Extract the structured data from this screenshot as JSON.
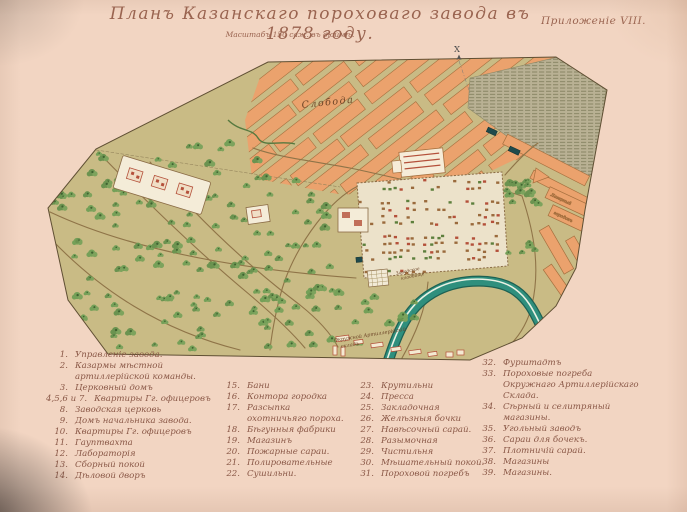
{
  "page": {
    "title": "Планъ Казанскаго пороховаго завода въ 1878 году.",
    "annex": "Приложеніе VIII.",
    "scale_note": "Масштабъ 150 саж. въ дюймѣ."
  },
  "map": {
    "labels": {
      "sloboda": "Слобода",
      "cemetery1": "Заводское",
      "cemetery2": "кладбище",
      "depot1": "Окружной Артиллерійскій",
      "depot2": "складъ",
      "camp1": "Лагерный",
      "camp2": "городокъ",
      "north_mark": "X"
    }
  },
  "legend": {
    "columns": [
      {
        "items": [
          {
            "n": "1.",
            "label": "Управленіе завода."
          },
          {
            "n": "2.",
            "label": "Казармы мѣстной артиллерійской команды."
          },
          {
            "n": "3.",
            "label": "Церковный домъ"
          },
          {
            "n": "4,5,6 и 7.",
            "label": "Квартиры Гг. офицеровъ"
          },
          {
            "n": "8.",
            "label": "Заводская церковь"
          },
          {
            "n": "9.",
            "label": "Домъ начальника завода."
          },
          {
            "n": "10.",
            "label": "Квартиры Гг. офицеровъ"
          },
          {
            "n": "11.",
            "label": "Гауптвахта"
          },
          {
            "n": "12.",
            "label": "Лабораторія"
          },
          {
            "n": "13.",
            "label": "Сборный покой"
          },
          {
            "n": "14.",
            "label": "Дѣловой дворъ"
          }
        ]
      },
      {
        "items": [
          {
            "n": "15.",
            "label": "Бани"
          },
          {
            "n": "16.",
            "label": "Контора городка"
          },
          {
            "n": "17.",
            "label": "Разсыпка охотничьяго пороха."
          },
          {
            "n": "18.",
            "label": "Бѣгунныя фабрики"
          },
          {
            "n": "19.",
            "label": "Магазинъ"
          },
          {
            "n": "20.",
            "label": "Пожарные сараи."
          },
          {
            "n": "21.",
            "label": "Полировательные"
          },
          {
            "n": "22.",
            "label": "Сушильни."
          }
        ]
      },
      {
        "items": [
          {
            "n": "23.",
            "label": "Крутильни"
          },
          {
            "n": "24.",
            "label": "Пресса"
          },
          {
            "n": "25.",
            "label": "Закладочная"
          },
          {
            "n": "26.",
            "label": "Желѣзныя бочки"
          },
          {
            "n": "27.",
            "label": "Навѣсочный сарай."
          },
          {
            "n": "28.",
            "label": "Разымочная"
          },
          {
            "n": "29.",
            "label": "Чистильня"
          },
          {
            "n": "30.",
            "label": "Мѣшательный покой."
          },
          {
            "n": "31.",
            "label": "Пороховой погребъ"
          }
        ]
      },
      {
        "items": [
          {
            "n": "32.",
            "label": "Фурштадтъ"
          },
          {
            "n": "33.",
            "label": "Пороховые погреба Окружнаго Артиллерійскаго Склада."
          },
          {
            "n": "34.",
            "label": "Сѣрный и селитряный магазины."
          },
          {
            "n": "35.",
            "label": "Угольный заводъ"
          },
          {
            "n": "36.",
            "label": "Сараи для бочекъ."
          },
          {
            "n": "37.",
            "label": "Плотничій сарай."
          },
          {
            "n": "38.",
            "label": "Магазины"
          },
          {
            "n": "39.",
            "label": "Магазины."
          }
        ]
      }
    ]
  },
  "colors": {
    "paper": "#f2d5c2",
    "ink": "#8a5847",
    "title_ink": "#9a6450",
    "ground": "#c9bb85",
    "blocks": "#eba26d",
    "blocks_edge": "#a6703f",
    "forest": "#74a058",
    "forest_dark": "#3f6331",
    "water": "#b9b194",
    "water_line": "#83805f",
    "river": "#2f8f7d",
    "river_bank": "#1d6153",
    "road": "#8f7448",
    "wall": "#8a6b45",
    "red": "#b4503a",
    "pale": "#ece2ca",
    "dark_bldg": "#1f4a4c"
  }
}
